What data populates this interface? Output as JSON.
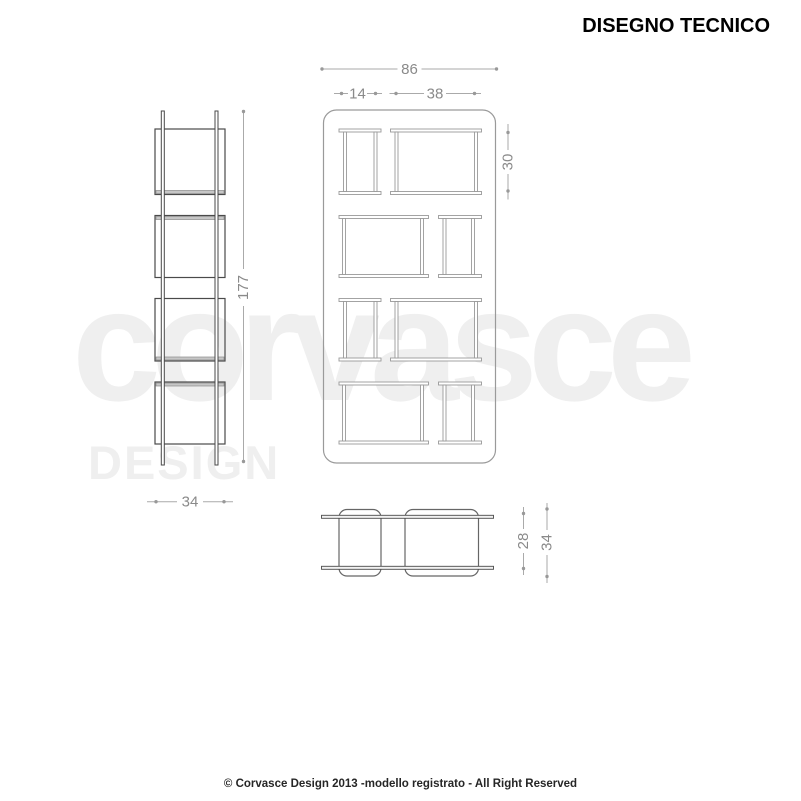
{
  "title": "DISEGNO TECNICO",
  "watermark": {
    "primary": "corvasce",
    "secondary": "DESIGN"
  },
  "footer": {
    "copyright": "© Corvasce Design  2013 -modello registrato - All Right Reserved"
  },
  "views": {
    "side": {
      "total_height_label": "177",
      "depth_label": "34"
    },
    "front": {
      "total_width_label": "86",
      "small_bay_label": "14",
      "large_bay_label": "38",
      "row_height_label": "30"
    },
    "plan": {
      "inner_depth_label": "28",
      "outer_depth_label": "34"
    }
  },
  "colors": {
    "front_lines": "#9a9a9a",
    "side_lines": "#4a4a4a",
    "dimension_lines": "#aaaaaa",
    "dimension_text": "#8a8a8a",
    "watermark": "#efefef",
    "title_text": "#000000",
    "footer_text": "#262626"
  }
}
